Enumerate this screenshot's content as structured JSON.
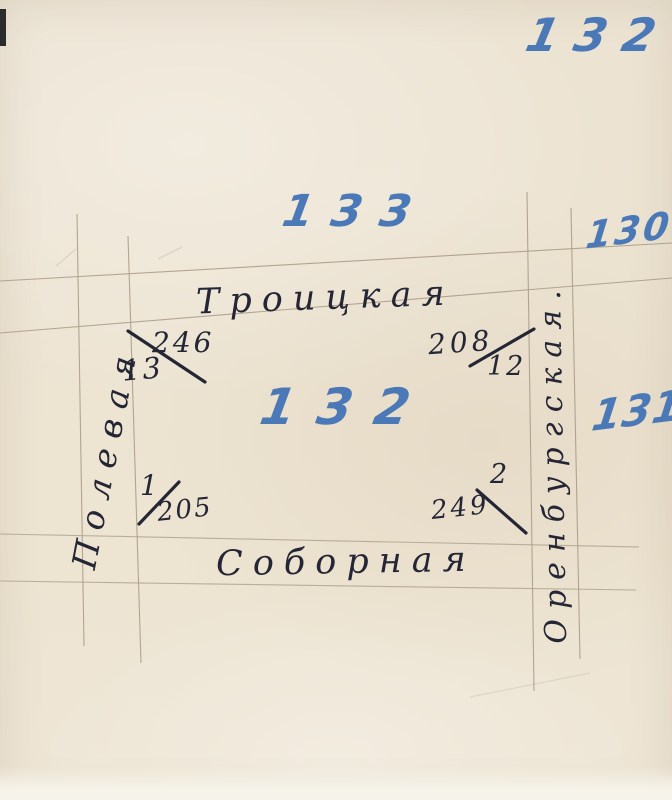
{
  "document": {
    "kind": "scanned hand-drawn city block plan",
    "paper_color": "#ece3d2",
    "pencil_color": "#a3947f",
    "ink_color": "#242636",
    "marker_color": "#4b79b7"
  },
  "sheet_number": "132",
  "blocks": {
    "north": "133",
    "northeast": "130",
    "center": "132",
    "east": "131"
  },
  "streets": {
    "north": "Троицкая",
    "south": "Соборная",
    "west": "Полевая",
    "east": "Оренбургская."
  },
  "corner_plots": {
    "top_left": {
      "upper": "246",
      "lower": "13"
    },
    "top_right": {
      "upper": "208",
      "lower": "12"
    },
    "bottom_left": {
      "upper": "1",
      "lower": "205"
    },
    "bottom_right": {
      "upper": "2",
      "lower": "249"
    }
  }
}
